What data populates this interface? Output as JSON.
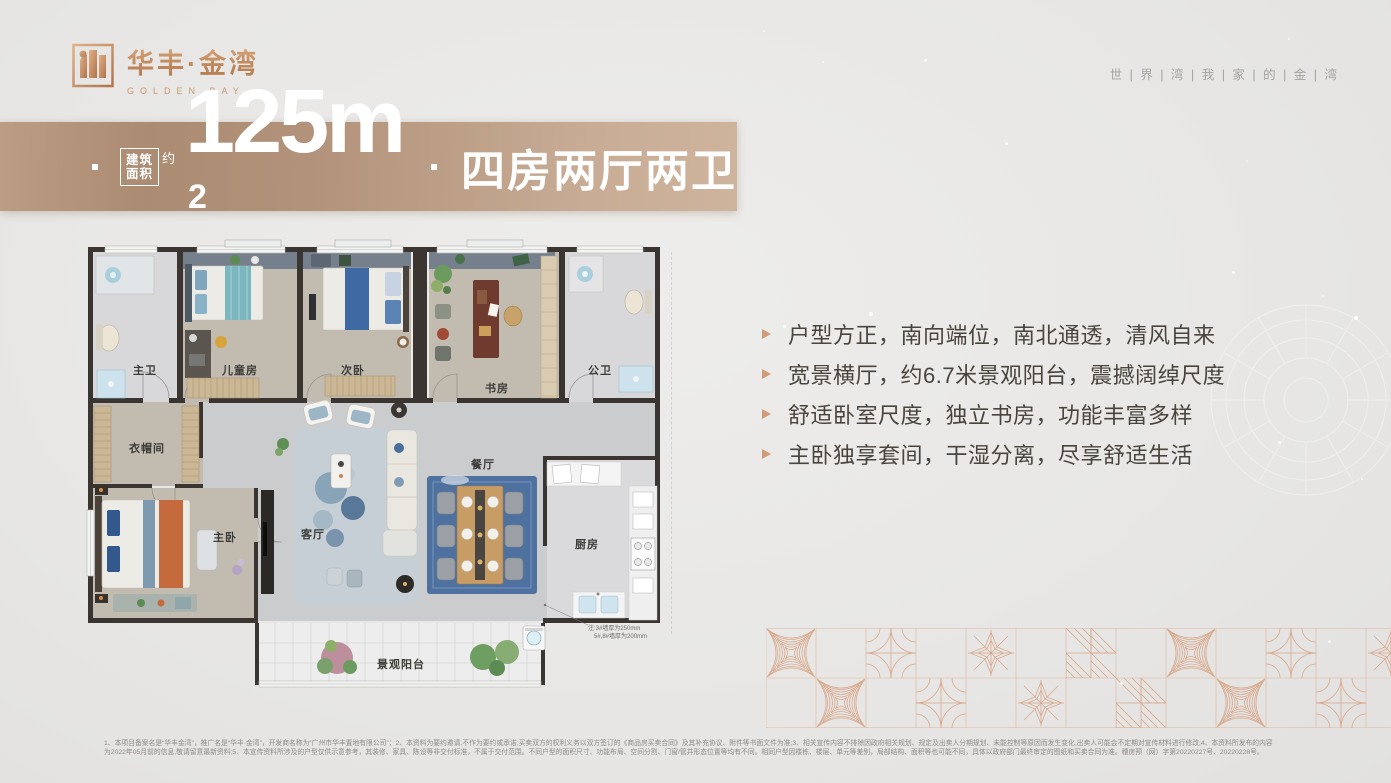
{
  "brand": {
    "logo_cn": "华丰·金湾",
    "logo_en": "GOLDEN BAY",
    "slogan": "世 | 界 | 湾 | 我 | 家 | 的 | 金 | 湾"
  },
  "banner": {
    "area_box": [
      "建筑",
      "面积"
    ],
    "approx": "约",
    "value": "125m",
    "sup": "2",
    "rooms": "四房两厅两卫"
  },
  "highlights": [
    "户型方正，南向端位，南北通透，清风自来",
    "宽景横厅，约6.7米景观阳台，震撼阔绰尺度",
    "舒适卧室尺度，独立书房，功能丰富多样",
    "主卧独享套间，干湿分离，尽享舒适生活"
  ],
  "floorplan": {
    "rooms": {
      "master_bath": "主卫",
      "kids_room": "儿童房",
      "second_bed": "次卧",
      "study": "书房",
      "guest_bath": "公卫",
      "cloakroom": "衣帽间",
      "master_bed": "主卧",
      "living": "客厅",
      "dining": "餐厅",
      "kitchen": "厨房",
      "balcony": "景观阳台"
    },
    "note1": "注:3#墙厚为250mm",
    "note2": "5#,8#墙厚为200mm"
  },
  "disclaimer": {
    "line1": "1、本项目备案名是“华丰金湾”，推广名是“华丰·金湾”，开发商名称为“广州市华丰置地有限公司”；2、本资料为要约邀请,不作为要约或承诺;买卖双方的权利义务以双方签订的《商品房买卖合同》及其补充协议、附件等书面文件为准;3、相关宣传内容不排除因政府相关规划、规定及出卖人分期规划、未能控制等原因而发生变化,出卖人可能会不定期对宣传材料进行修改;4、本资料所发布的内容",
    "line2": "为2022年05月前的信息,敬请留意最新资料;5、本宣传资料所涉及的户型仅供示意参考，其装修、家具、陈设等非交付标准，不属于交付范围。不同户型的面积尺寸、功能布局、空间分割、门窗/管井形态位置等均有不同。相同户型因楼栋、楼层、单元等差别，局部结构、面积等也可能不同，具体以政府部门最终审定的图纸和买卖合同为准。穗房预（网）字第20220227号、20220228号。"
  },
  "colors": {
    "copper": "#c08a5e",
    "banner_left": "#ab8b71",
    "banner_right": "#cfb49d",
    "text_dark": "#4a443f",
    "pattern_copper": "#d9a98c"
  }
}
